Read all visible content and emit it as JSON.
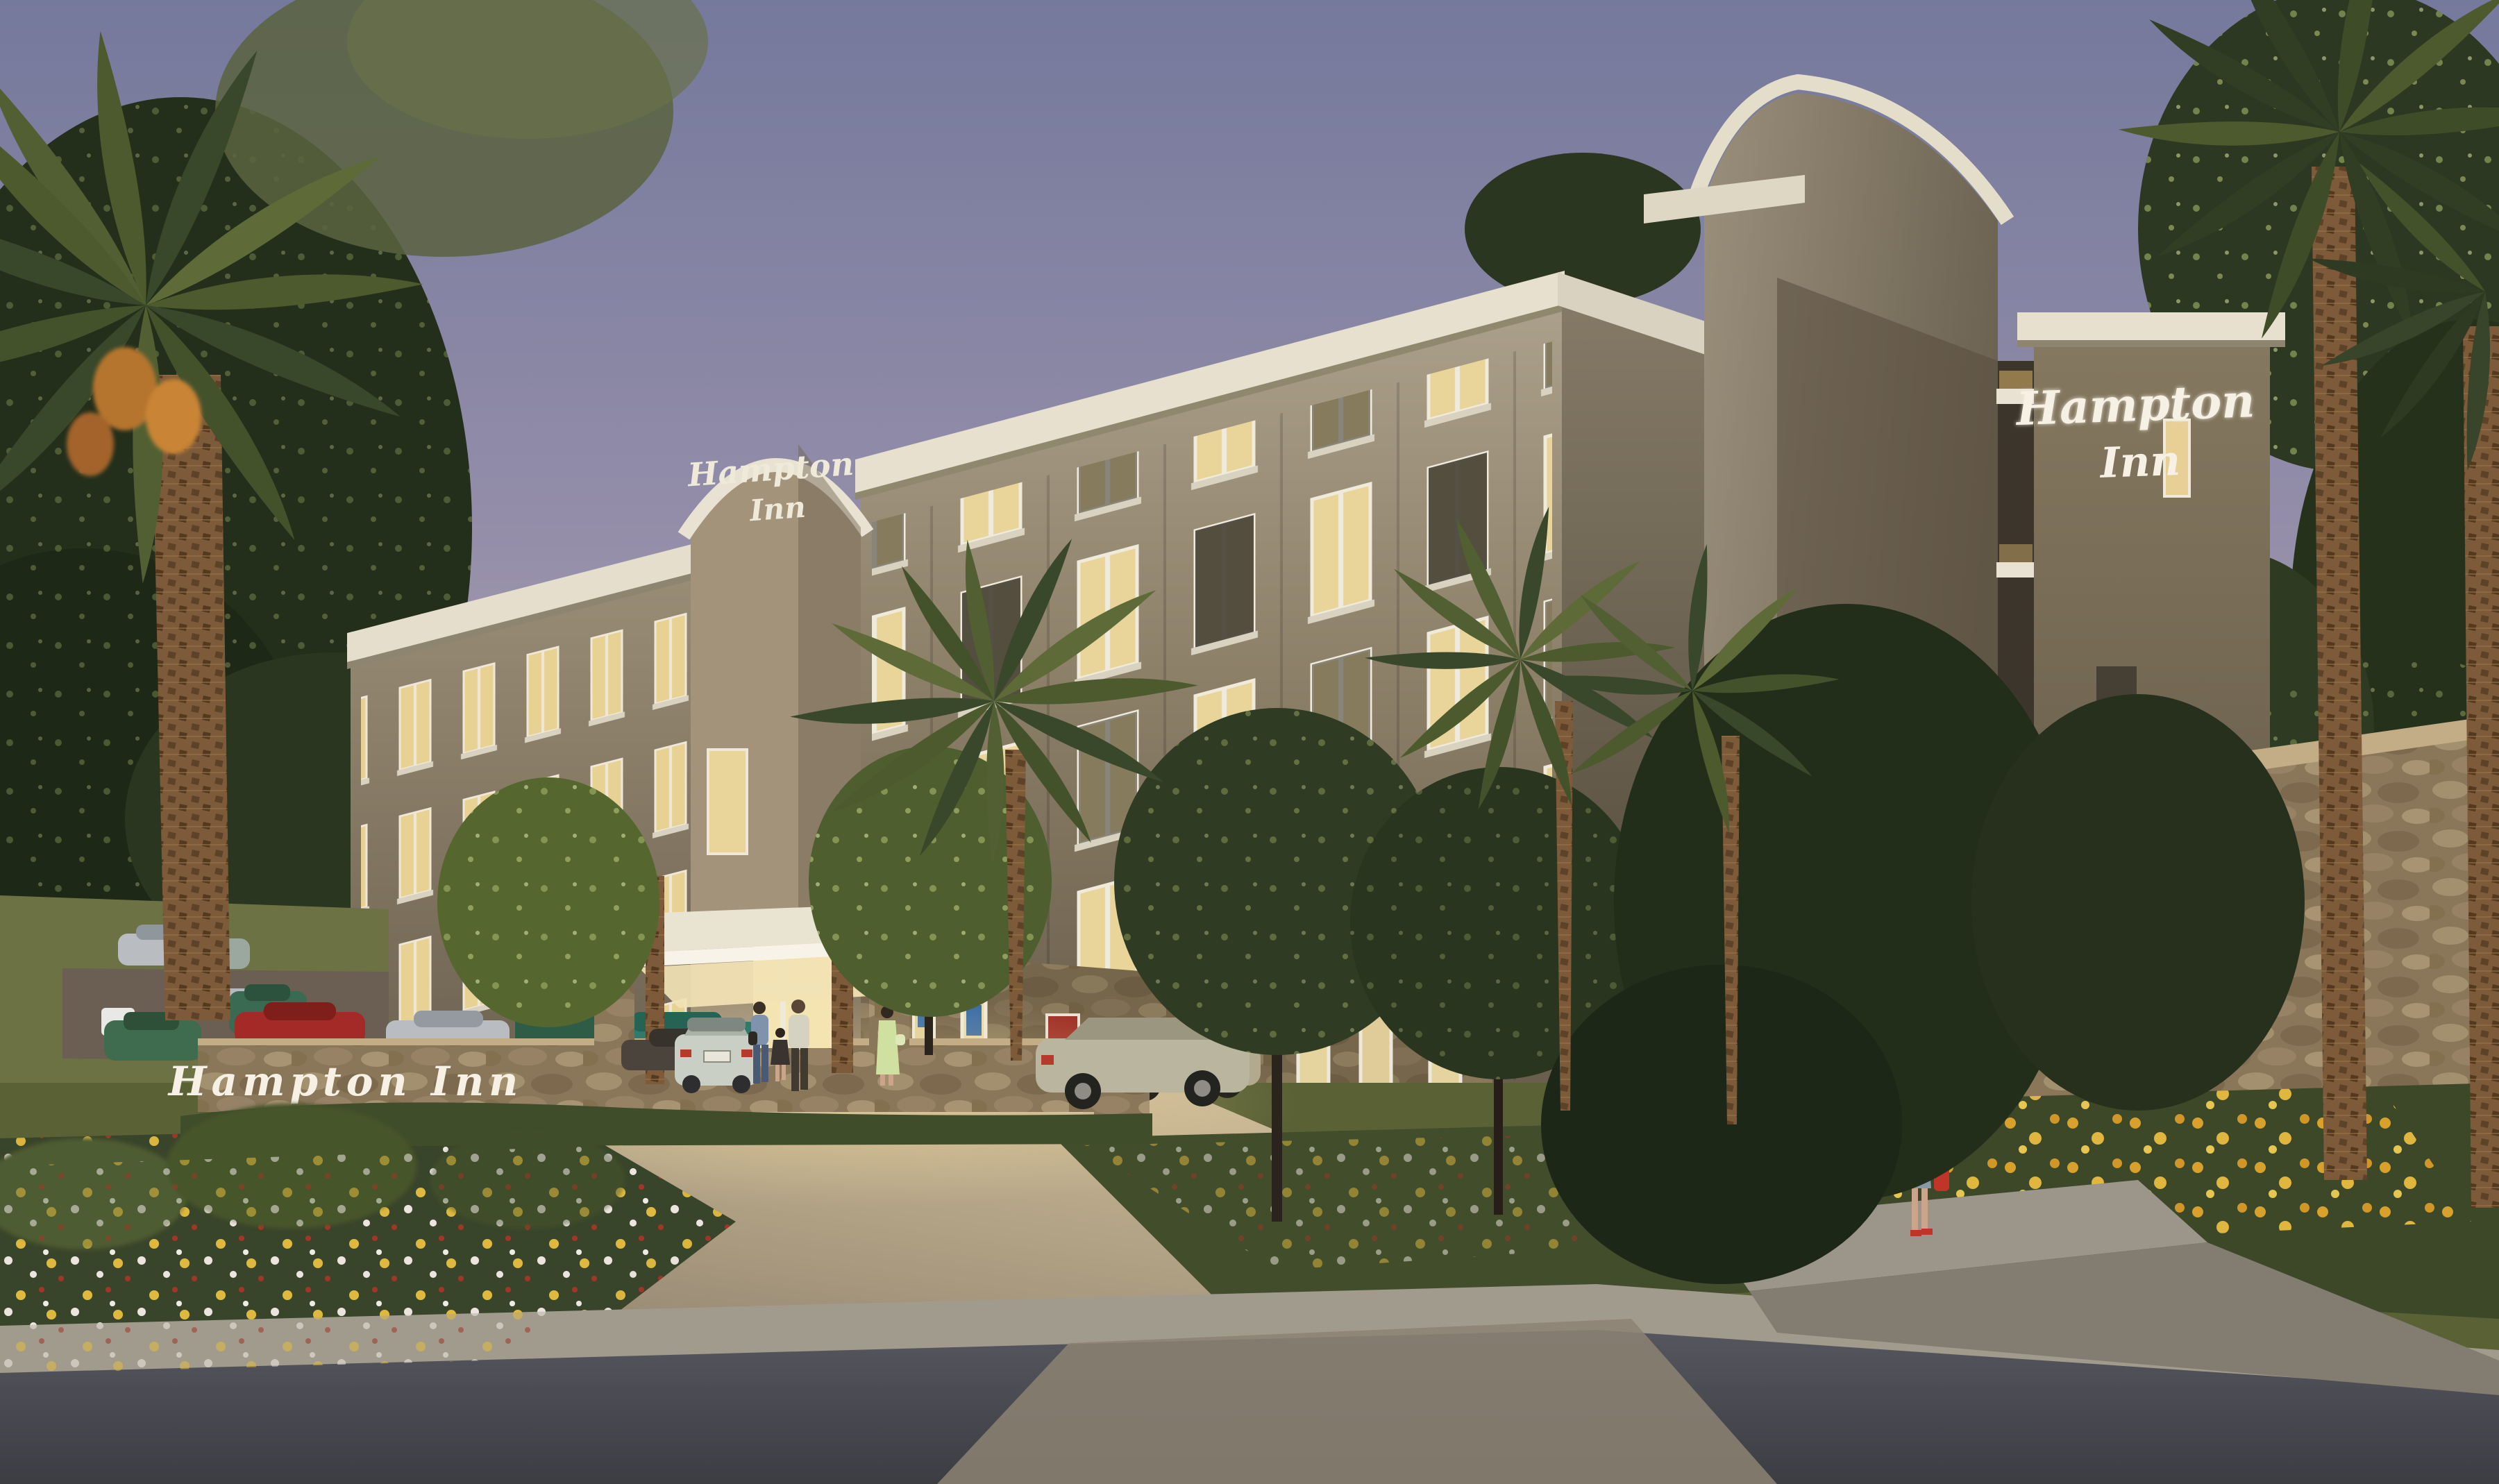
{
  "scene": {
    "description_labels": {
      "monument_sign_text": "Hampton Inn",
      "entrance_sign_line1": "Hampton",
      "entrance_sign_line2": "Inn",
      "tower_sign_line1": "Hampton",
      "tower_sign_line2": "Inn"
    },
    "palette": {
      "sky_top": "#75799c",
      "sky_mid": "#a49bae",
      "sky_horizon": "#d8c8c1",
      "facade_lit": "#a79b85",
      "facade_shadow": "#5e5445",
      "cornice": "#e7e0cf",
      "window_glow": "#e9d59a",
      "stone": "#8a775a",
      "canopy": "#efe9da",
      "grass": "#4f5a33",
      "street": "#47484e",
      "sidewalk": "#a19b8e",
      "palm_frond": "#4c5a2e",
      "palm_trunk": "#7c5a3a",
      "flower_yellow": "#e3bc3e",
      "flower_white": "#efe9e2",
      "flower_red": "#a33527",
      "sign_script_white": "#f6f1e4"
    }
  }
}
